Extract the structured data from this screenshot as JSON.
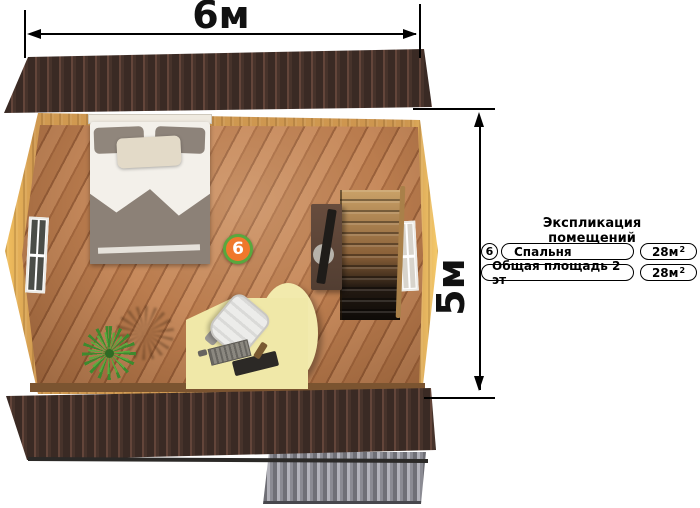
{
  "plan": {
    "dimension_width_label": "6м",
    "dimension_height_label": "5м",
    "room_marker_number": "6"
  },
  "legend": {
    "title": "Экспликация помещений",
    "rows": [
      {
        "number": "6",
        "name": "Спальня",
        "area_value": "28м",
        "area_sup": "2"
      },
      {
        "name": "Общая площадь 2 эт",
        "area_value": "28м",
        "area_sup": "2"
      }
    ]
  },
  "colors": {
    "marker_fill": "#f0782c",
    "marker_ring": "#58a83e",
    "roof": "#3a2a24",
    "floor_wood": "#b5774a",
    "wall_wood": "#d09950",
    "desk": "#f0e8a8"
  }
}
